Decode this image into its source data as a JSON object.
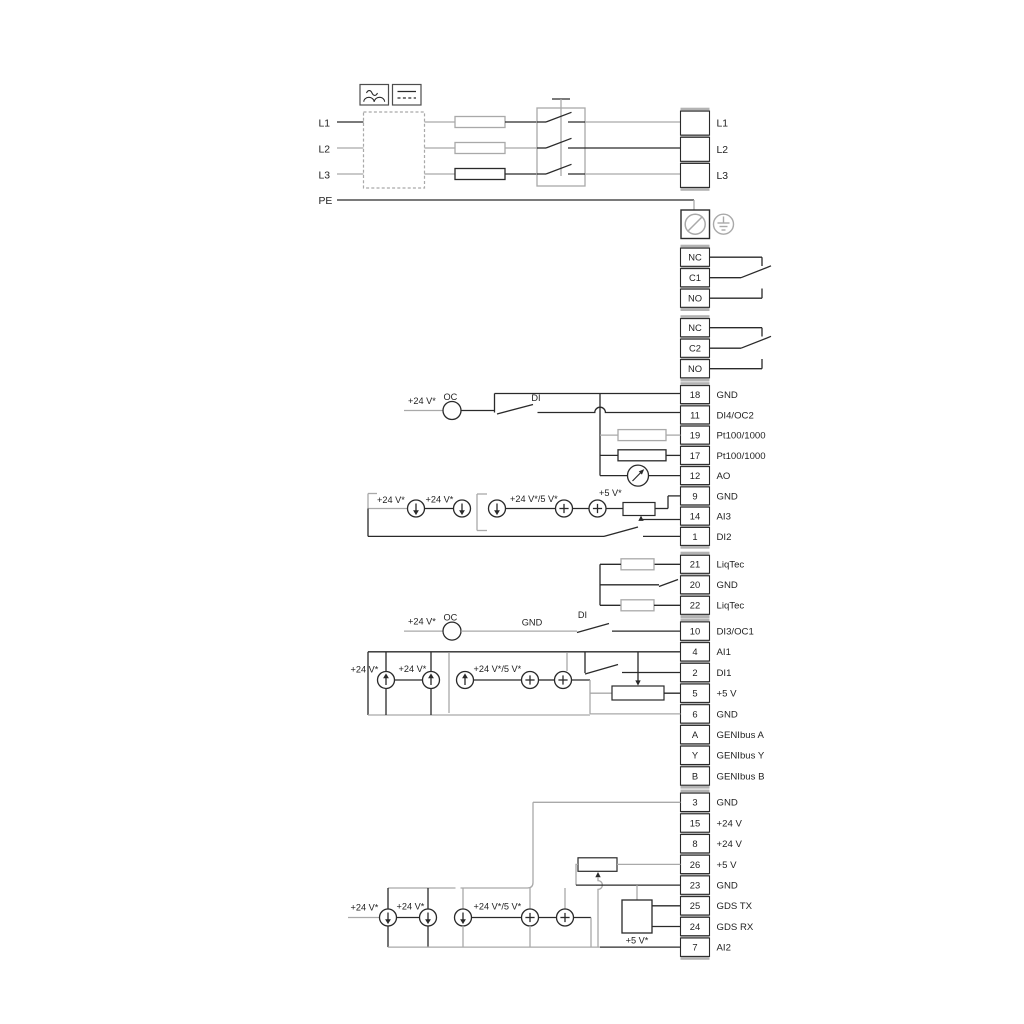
{
  "diagram": {
    "power": {
      "inputs": [
        "L1",
        "L2",
        "L3"
      ],
      "pe": "PE",
      "outputs": [
        "L1",
        "L2",
        "L3"
      ]
    },
    "relays": [
      {
        "terminals": [
          "NC",
          "C1",
          "NO"
        ]
      },
      {
        "terminals": [
          "NC",
          "C2",
          "NO"
        ]
      }
    ],
    "groups": {
      "io_top": [
        {
          "id": "18",
          "label": "GND"
        },
        {
          "id": "11",
          "label": "DI4/OC2"
        },
        {
          "id": "19",
          "label": "Pt100/1000"
        },
        {
          "id": "17",
          "label": "Pt100/1000"
        },
        {
          "id": "12",
          "label": "AO"
        },
        {
          "id": "9",
          "label": "GND"
        },
        {
          "id": "14",
          "label": "AI3"
        },
        {
          "id": "1",
          "label": "DI2"
        }
      ],
      "liqtec": [
        {
          "id": "21",
          "label": "LiqTec"
        },
        {
          "id": "20",
          "label": "GND"
        },
        {
          "id": "22",
          "label": "LiqTec"
        }
      ],
      "io_mid": [
        {
          "id": "10",
          "label": "DI3/OC1"
        },
        {
          "id": "4",
          "label": "AI1"
        },
        {
          "id": "2",
          "label": "DI1"
        },
        {
          "id": "5",
          "label": "+5 V"
        },
        {
          "id": "6",
          "label": "GND"
        },
        {
          "id": "A",
          "label": "GENIbus A"
        },
        {
          "id": "Y",
          "label": "GENIbus Y"
        },
        {
          "id": "B",
          "label": "GENIbus B"
        }
      ],
      "io_bottom": [
        {
          "id": "3",
          "label": "GND"
        },
        {
          "id": "15",
          "label": "+24 V"
        },
        {
          "id": "8",
          "label": "+24 V"
        },
        {
          "id": "26",
          "label": "+5 V"
        },
        {
          "id": "23",
          "label": "GND"
        },
        {
          "id": "25",
          "label": "GDS TX"
        },
        {
          "id": "24",
          "label": "GDS RX"
        },
        {
          "id": "7",
          "label": "AI2"
        }
      ]
    },
    "annotations": {
      "v24": "+24 V*",
      "v24_5": "+24 V*/5 V*",
      "v5": "+5 V*",
      "oc": "OC",
      "di": "DI",
      "gnd": "GND"
    },
    "colors": {
      "line": "#2a2a2a",
      "line_gray": "#a9a9a9",
      "backing": "#b3b3b3"
    }
  }
}
